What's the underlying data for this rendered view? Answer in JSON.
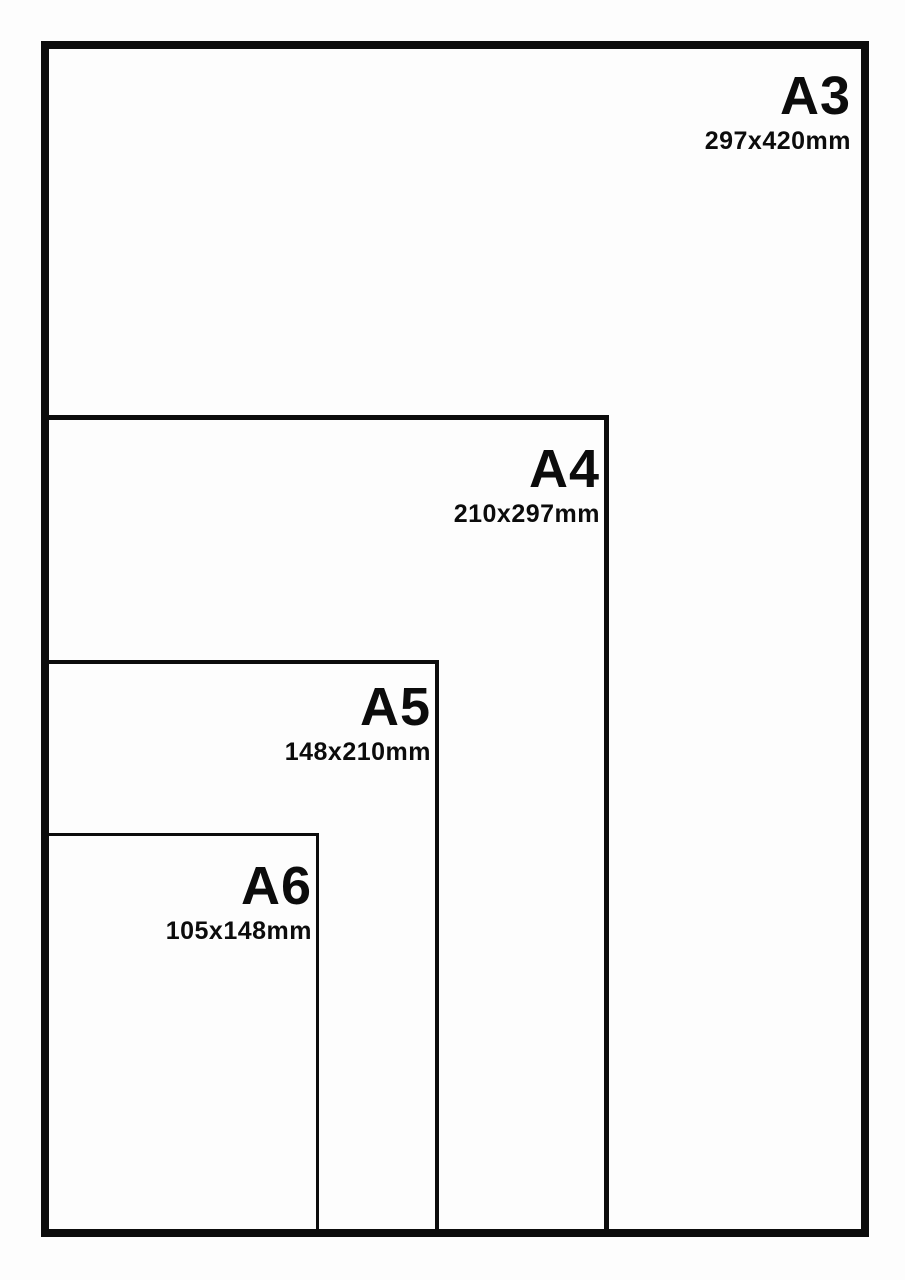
{
  "diagram": {
    "title": "paper-size-comparison",
    "line_color": "#0c0c0c",
    "background_color": "#fdfdfd"
  },
  "sizes": [
    {
      "id": "a3",
      "label": "A3",
      "dimensions": "297x420mm"
    },
    {
      "id": "a4",
      "label": "A4",
      "dimensions": "210x297mm"
    },
    {
      "id": "a5",
      "label": "A5",
      "dimensions": "148x210mm"
    },
    {
      "id": "a6",
      "label": "A6",
      "dimensions": "105x148mm"
    }
  ]
}
